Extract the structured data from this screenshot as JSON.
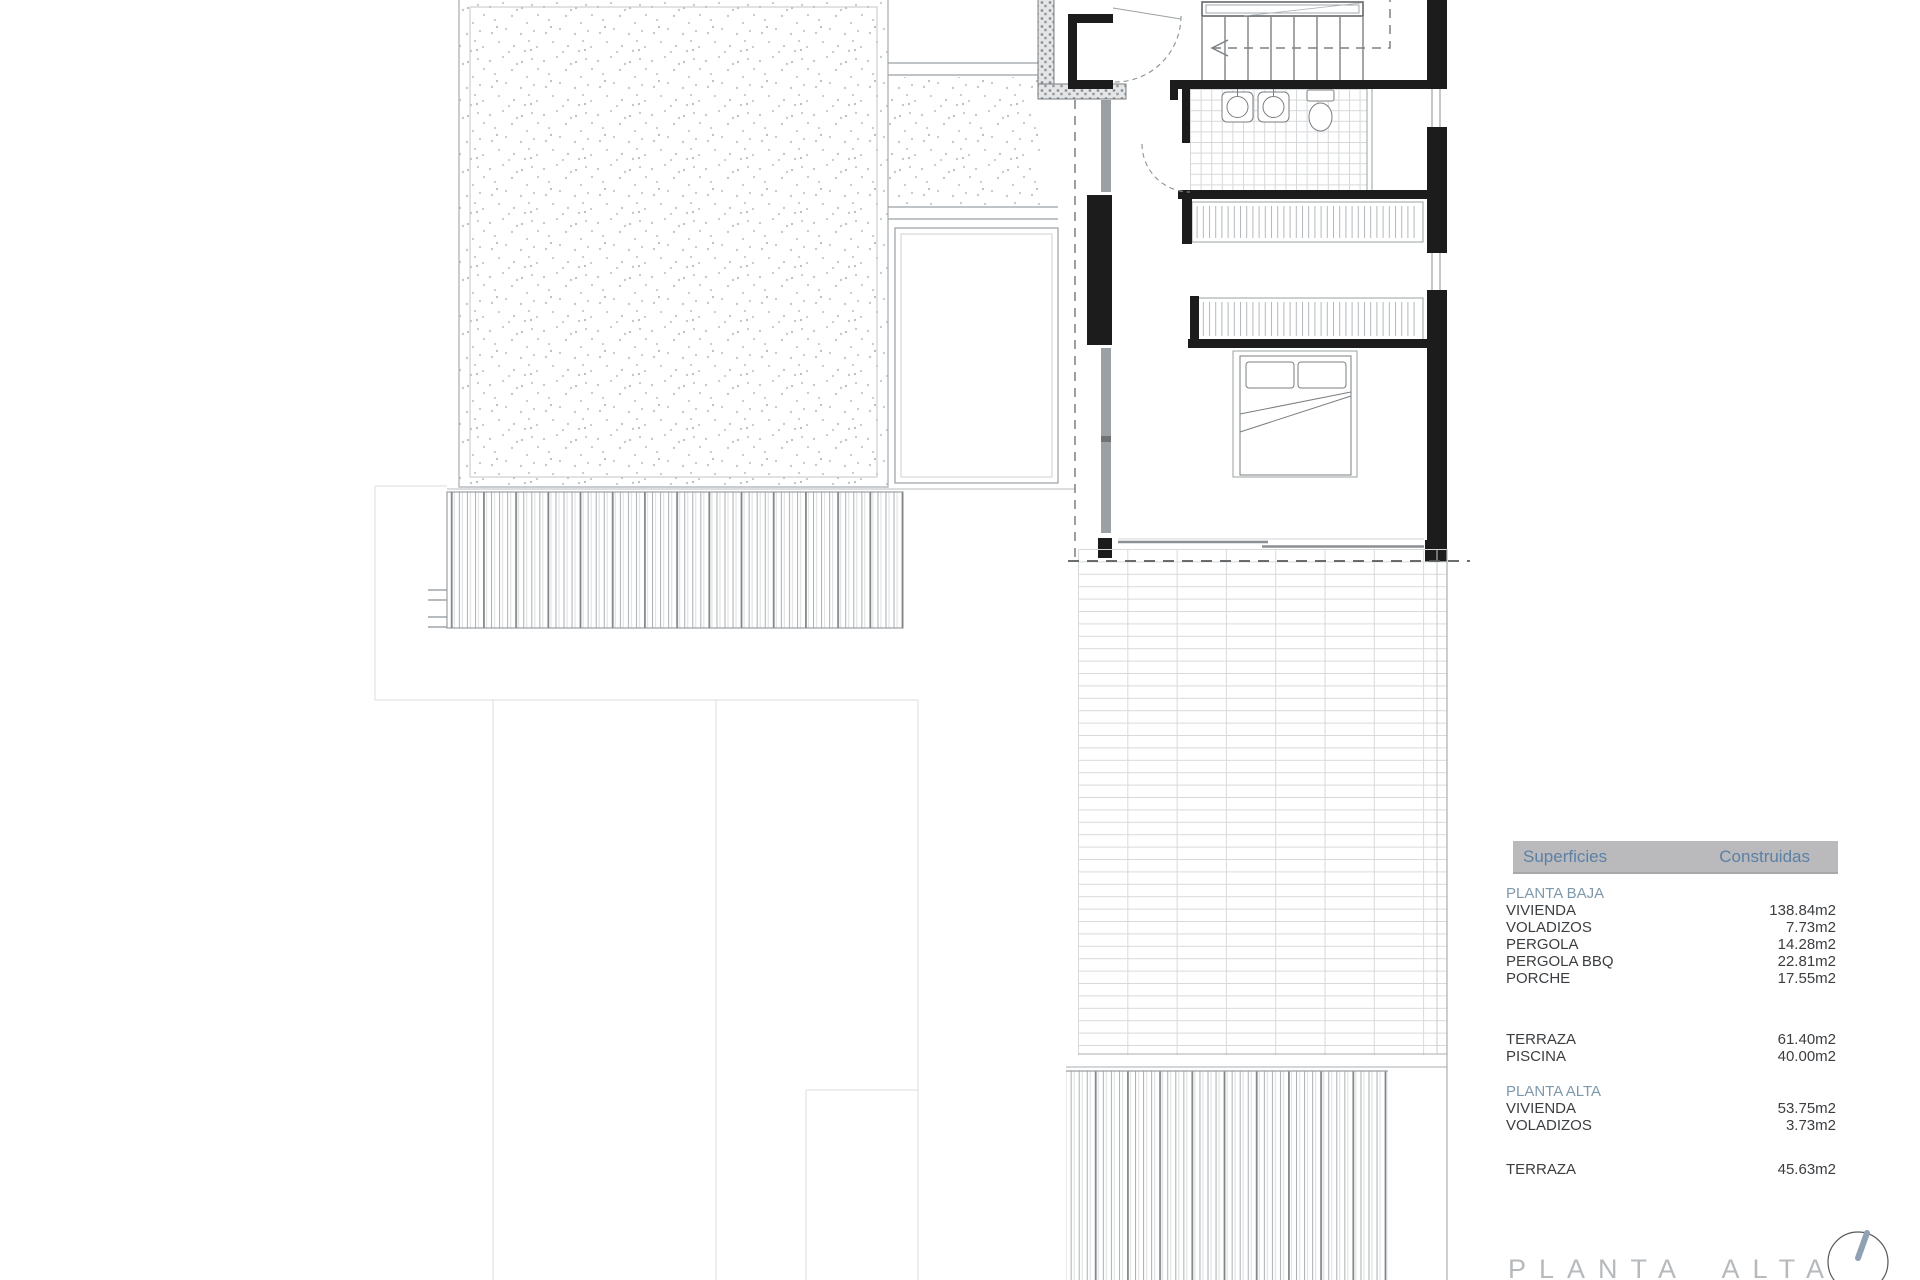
{
  "footer": {
    "title": "PLANTA ALTA"
  },
  "surfaces": {
    "header": {
      "col1": "Superficies",
      "col2": "Construidas"
    },
    "rows": [
      {
        "label": "PLANTA BAJA",
        "value": "",
        "type": "section"
      },
      {
        "label": "VIVIENDA",
        "value": "138.84m2"
      },
      {
        "label": "VOLADIZOS",
        "value": "7.73m2"
      },
      {
        "label": "PERGOLA",
        "value": "14.28m2"
      },
      {
        "label": "PERGOLA BBQ",
        "value": "22.81m2"
      },
      {
        "label": "PORCHE",
        "value": "17.55m2"
      },
      {
        "label": "TERRAZA",
        "value": "61.40m2"
      },
      {
        "label": "PISCINA",
        "value": "40.00m2"
      },
      {
        "label": "PLANTA ALTA",
        "value": "",
        "type": "section"
      },
      {
        "label": "VIVIENDA",
        "value": "53.75m2"
      },
      {
        "label": "VOLADIZOS",
        "value": "3.73m2"
      },
      {
        "label": "TERRAZA",
        "value": "45.63m2"
      }
    ]
  },
  "icons": {
    "compass": "north-indicator-circle"
  },
  "colors": {
    "header_bar_gray": "#bababc",
    "header_text_blue": "#5d80a6",
    "section_text_blue": "#7e98ab",
    "row_text": "#3b3e41",
    "title_gray": "#b6babd",
    "wall_black": "#1c1c1c",
    "compass_needle": "#8fa1b3"
  }
}
